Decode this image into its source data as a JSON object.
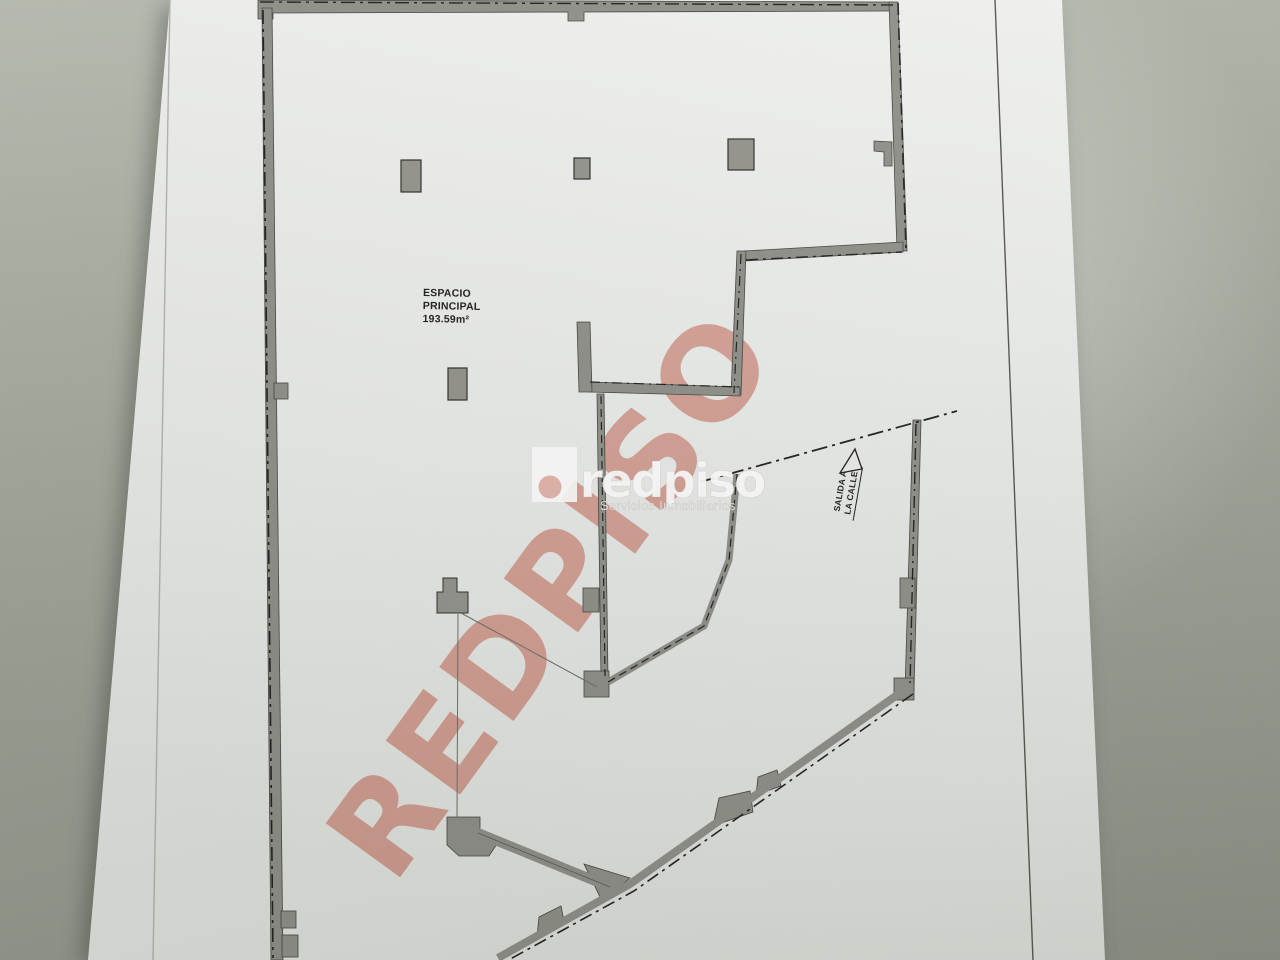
{
  "scene": {
    "description": "photo of a printed floor plan on a desk",
    "desk_color": "#9aa094",
    "paper_color": "#ecedea"
  },
  "plan": {
    "room_label": {
      "line1": "ESPACIO",
      "line2": "PRINCIPAL",
      "line3": "193.59m²"
    },
    "exit_label": {
      "line1": "SALIDA A",
      "line2": "LA CALLE"
    },
    "wall_color": "#8f9089",
    "line_color": "#1f1f1d"
  },
  "watermark": {
    "text": "REDPISO",
    "color": "#bf5440"
  },
  "logo": {
    "brand": "redpiso",
    "tagline": "Servicios Inmobiliarios"
  }
}
